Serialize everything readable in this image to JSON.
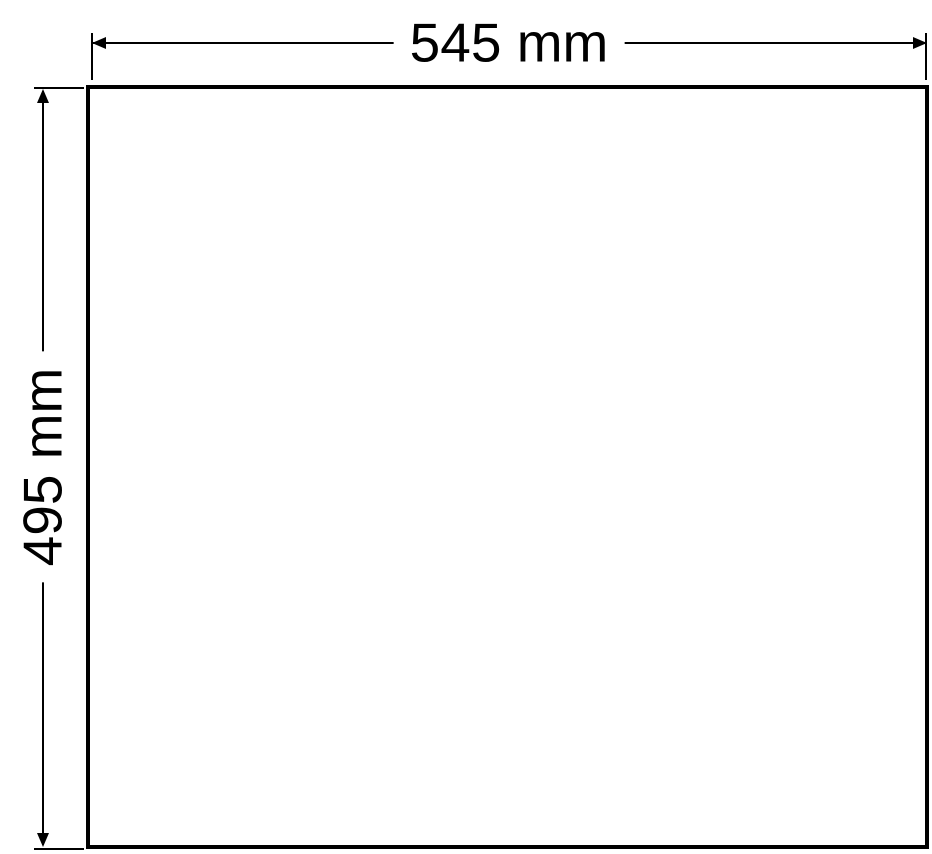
{
  "diagram": {
    "width_label": "545 mm",
    "height_label": "495 mm",
    "colors": {
      "line": "#000000",
      "text": "#000000",
      "background": "#ffffff"
    }
  }
}
